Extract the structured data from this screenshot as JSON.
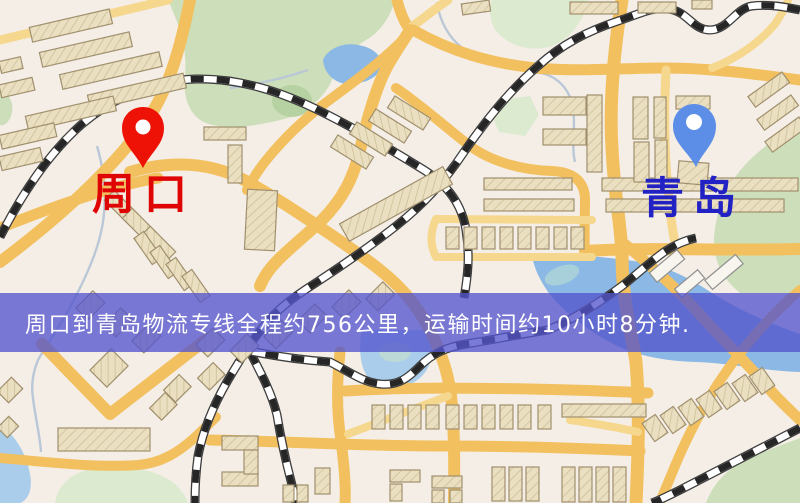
{
  "map": {
    "markers": [
      {
        "id": "origin",
        "label": "周口",
        "pin_color": "#ed1205",
        "label_color": "#e00505"
      },
      {
        "id": "destination",
        "label": "青岛",
        "pin_color": "#5c8ee8",
        "label_color": "#2121c4"
      }
    ],
    "banner": {
      "text": "周口到青岛物流专线全程约756公里，运输时间约10小时8分钟.",
      "bg_color": "rgba(84,86,205,0.78)",
      "text_color": "#ffffff"
    },
    "route": {
      "origin": "周口",
      "destination": "青岛",
      "distance_km": "756",
      "duration": "10小时8分钟"
    },
    "palette": {
      "background": "#f5eee7",
      "road_major": "#f2c05e",
      "road_minor": "#f5d78d",
      "building": "#eadfc0",
      "green_area": "#ccdfba",
      "water": "#8bb8e4",
      "railway": "#262626"
    }
  }
}
